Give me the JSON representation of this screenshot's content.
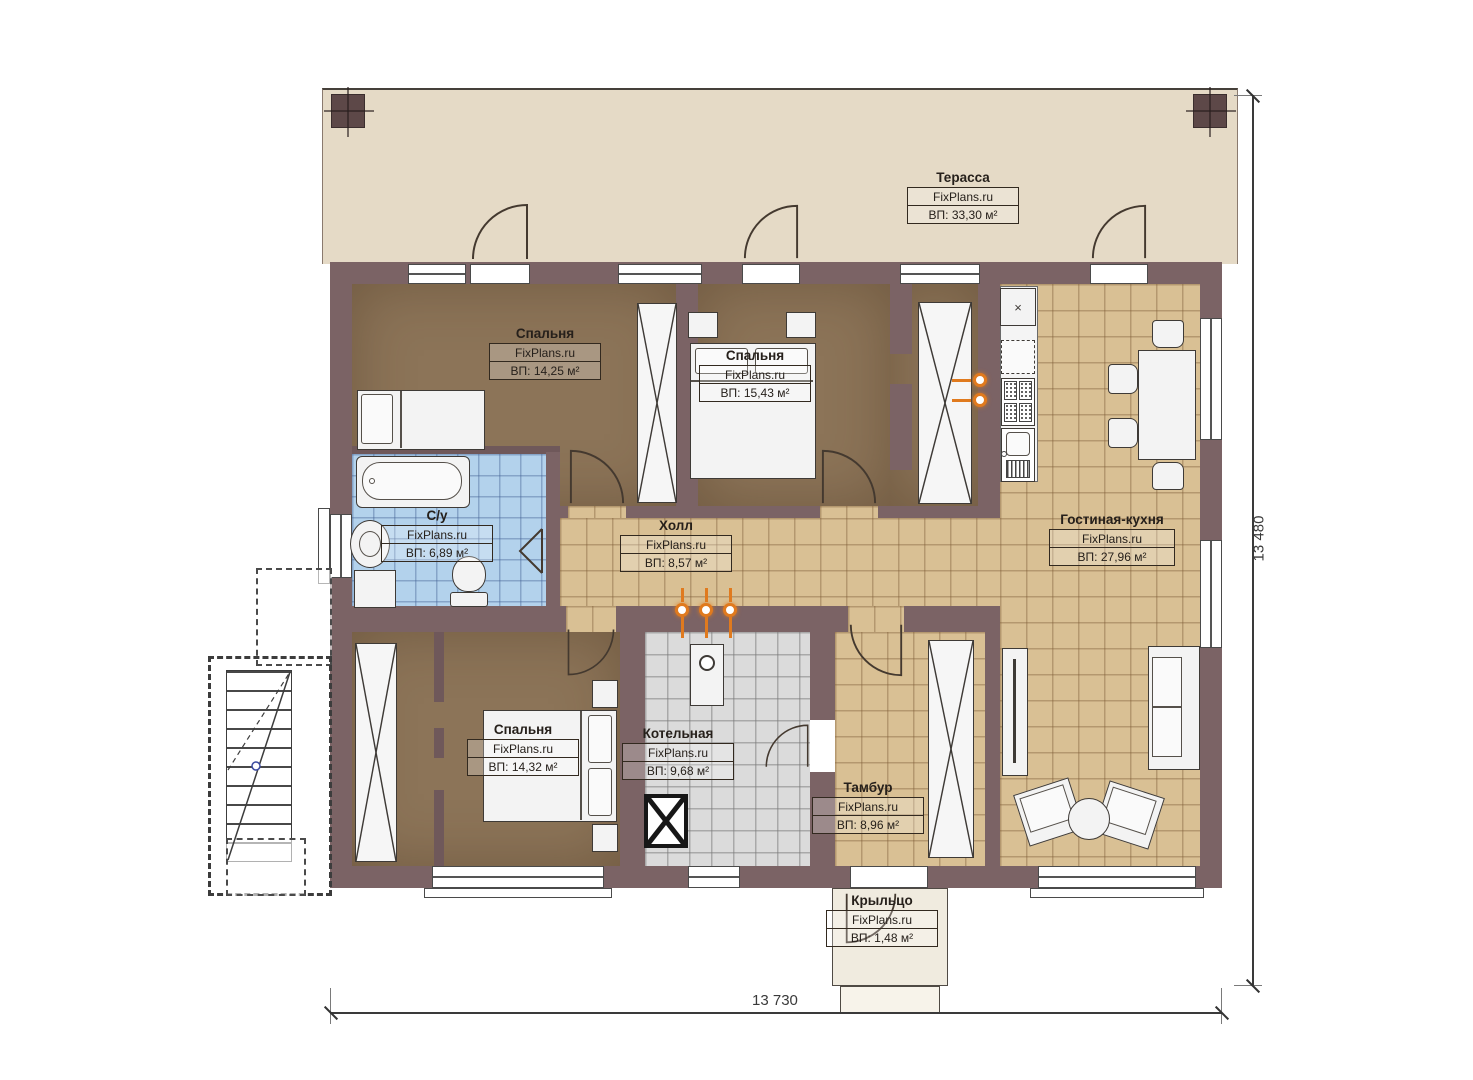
{
  "title": "Floor plan",
  "watermark": "FixPlans.ru",
  "rooms": [
    {
      "id": "terrace",
      "name": "Терасса",
      "area": "ВП: 33,30 м²"
    },
    {
      "id": "bedroom-1",
      "name": "Спальня",
      "area": "ВП: 14,25 м²"
    },
    {
      "id": "bedroom-2",
      "name": "Спальня",
      "area": "ВП: 15,43 м²"
    },
    {
      "id": "bathroom",
      "name": "С/у",
      "area": "ВП: 6,89 м²"
    },
    {
      "id": "hall",
      "name": "Холл",
      "area": "ВП: 8,57 м²"
    },
    {
      "id": "living-kitchen",
      "name": "Гостиная-кухня",
      "area": "ВП: 27,96 м²"
    },
    {
      "id": "bedroom-3",
      "name": "Спальня",
      "area": "ВП: 14,32 м²"
    },
    {
      "id": "boiler-room",
      "name": "Котельная",
      "area": "ВП: 9,68 м²"
    },
    {
      "id": "vestibule",
      "name": "Тамбур",
      "area": "ВП: 8,96 м²"
    },
    {
      "id": "porch",
      "name": "Крыльцо",
      "area": "ВП: 1,48 м²"
    }
  ],
  "dimensions": {
    "bottom": "13 730",
    "right": "13 480"
  },
  "colors": {
    "wall": "#7b6365",
    "terrace_floor": "#e5dac6",
    "wood_floor": "#8c7458",
    "tile_tan": "#d9c094",
    "tile_blue": "#b3d2ec",
    "tile_gray": "#dbdbdb",
    "gas_accent": "#e07a1e"
  }
}
